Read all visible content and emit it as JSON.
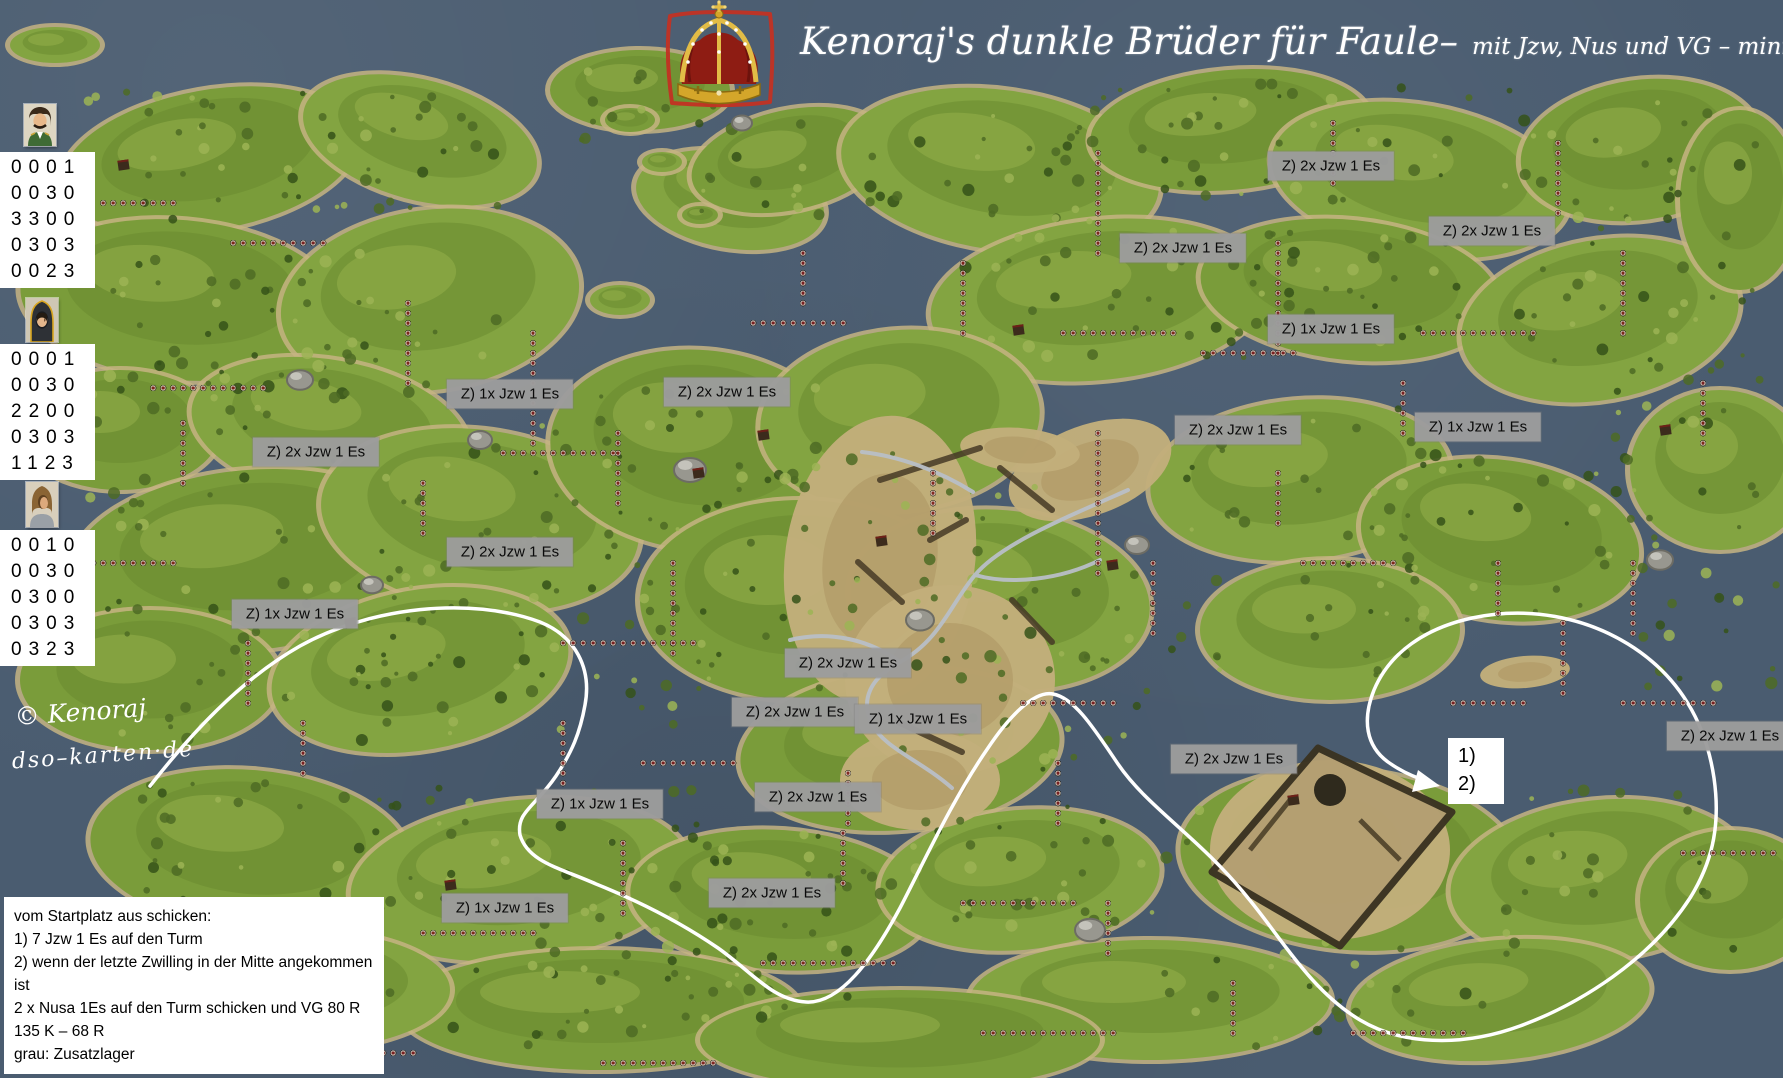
{
  "title": {
    "main": "Kenoraj's dunkle Brüder für Faule–",
    "sub": "mit Jzw, Nus und VG – minimale Verluste"
  },
  "watermark": {
    "line1": "© Kenoraj",
    "line2": "dso–karten·de"
  },
  "generals": [
    {
      "name": "general-moustache",
      "rows": [
        "0001",
        "0030",
        "3300",
        "0303",
        "0023"
      ]
    },
    {
      "name": "dark-hooded-general",
      "rows": [
        "0001",
        "0030",
        "2200",
        "0303",
        "1123"
      ]
    },
    {
      "name": "brown-hooded-general",
      "rows": [
        "0010",
        "0030",
        "0300",
        "0303",
        "0323"
      ]
    }
  ],
  "labels": [
    {
      "x": 1331,
      "y": 166,
      "text": "Z) 2x Jzw 1 Es"
    },
    {
      "x": 1183,
      "y": 248,
      "text": "Z) 2x Jzw 1 Es"
    },
    {
      "x": 1492,
      "y": 231,
      "text": "Z) 2x Jzw 1 Es"
    },
    {
      "x": 1331,
      "y": 329,
      "text": "Z) 1x Jzw 1 Es"
    },
    {
      "x": 510,
      "y": 394,
      "text": "Z) 1x Jzw 1 Es"
    },
    {
      "x": 727,
      "y": 392,
      "text": "Z) 2x Jzw 1 Es"
    },
    {
      "x": 316,
      "y": 452,
      "text": "Z) 2x Jzw 1 Es"
    },
    {
      "x": 510,
      "y": 552,
      "text": "Z) 2x Jzw 1 Es"
    },
    {
      "x": 295,
      "y": 614,
      "text": "Z) 1x Jzw 1 Es"
    },
    {
      "x": 1238,
      "y": 430,
      "text": "Z) 2x Jzw 1 Es"
    },
    {
      "x": 1478,
      "y": 427,
      "text": "Z) 1x Jzw 1 Es"
    },
    {
      "x": 848,
      "y": 663,
      "text": "Z) 2x Jzw 1 Es"
    },
    {
      "x": 795,
      "y": 712,
      "text": "Z) 2x Jzw 1 Es"
    },
    {
      "x": 918,
      "y": 719,
      "text": "Z) 1x Jzw 1 Es"
    },
    {
      "x": 818,
      "y": 797,
      "text": "Z) 2x Jzw 1 Es"
    },
    {
      "x": 1234,
      "y": 759,
      "text": "Z) 2x Jzw 1 Es"
    },
    {
      "x": 1730,
      "y": 736,
      "text": "Z) 2x Jzw 1 Es"
    },
    {
      "x": 600,
      "y": 804,
      "text": "Z) 1x Jzw 1 Es"
    },
    {
      "x": 772,
      "y": 893,
      "text": "Z) 2x Jzw 1 Es"
    },
    {
      "x": 505,
      "y": 908,
      "text": "Z) 1x Jzw 1 Es"
    }
  ],
  "route_note": {
    "line1": "1)",
    "line2": "2)"
  },
  "instructions": {
    "lines": [
      "vom Startplatz aus schicken:",
      "1) 7 Jzw 1 Es auf den Turm",
      "2) wenn der letzte Zwilling in der Mitte angekommen ist",
      "2 x Nusa 1Es auf den Turm schicken und VG 80 R 135 K – 68 R",
      "grau: Zusatzlager"
    ]
  },
  "colors": {
    "water": "#4a5c70",
    "island_green": "#7fa03c",
    "desert": "#c2ae7b",
    "label_bg": "#9c9c9c",
    "route": "#ffffff",
    "crown_red": "#8e1c13",
    "crown_gold": "#d4a62a",
    "border_red": "#c23223"
  }
}
